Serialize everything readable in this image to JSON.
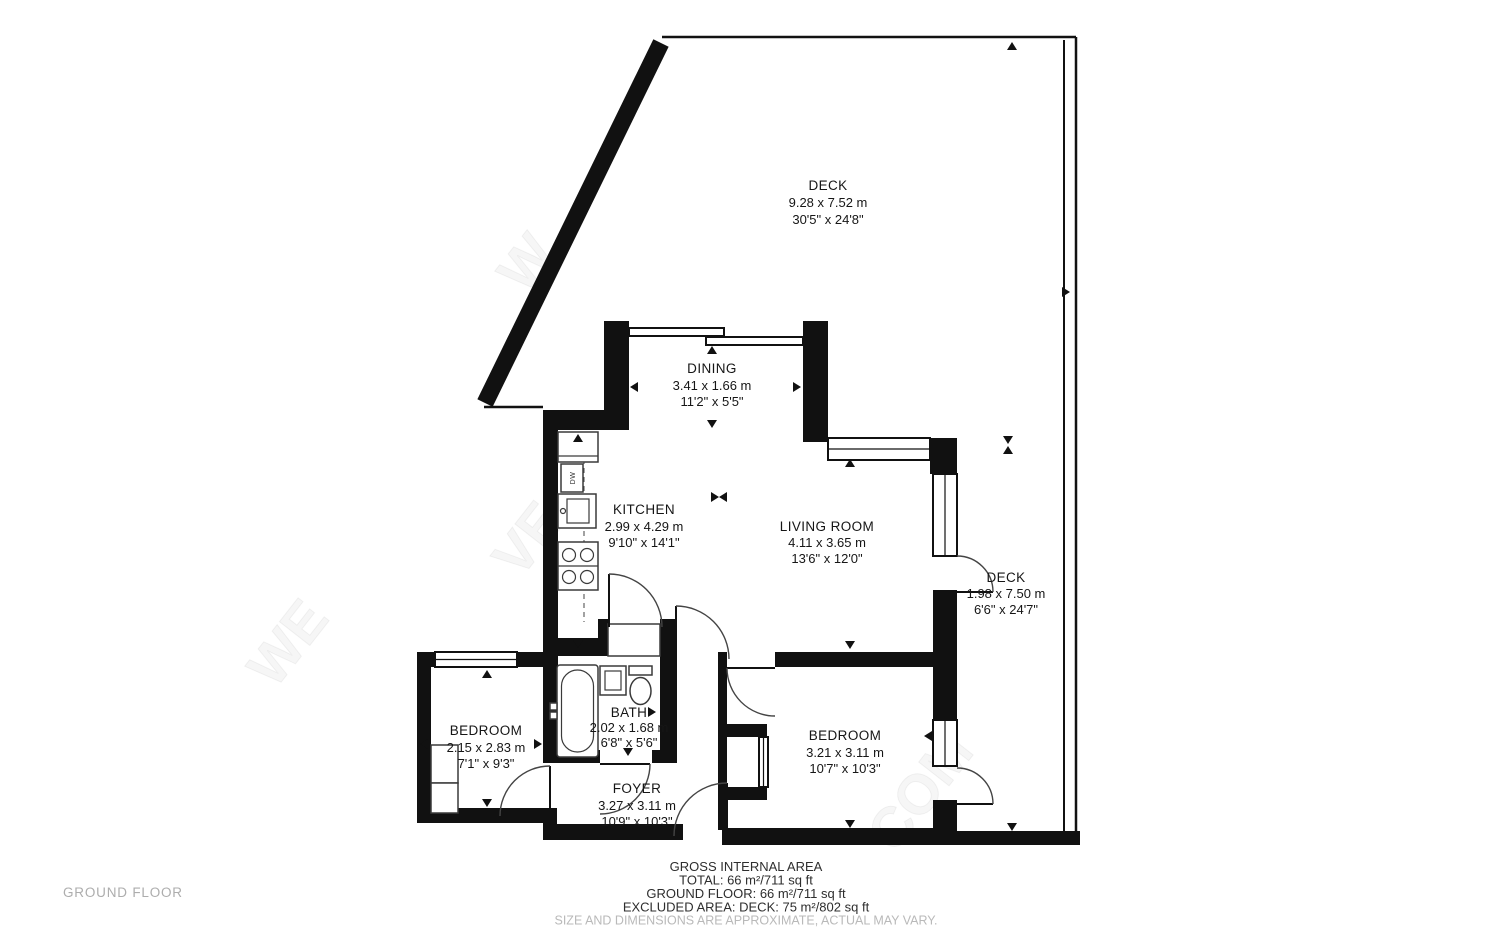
{
  "floor_label": "GROUND FLOOR",
  "rooms": [
    {
      "id": "deck-main",
      "name": "DECK",
      "metric": "9.28 x 7.52 m",
      "imperial": "30'5\" x 24'8\""
    },
    {
      "id": "dining",
      "name": "DINING",
      "metric": "3.41 x 1.66 m",
      "imperial": "11'2\" x 5'5\""
    },
    {
      "id": "kitchen",
      "name": "KITCHEN",
      "metric": "2.99 x 4.29 m",
      "imperial": "9'10\" x 14'1\""
    },
    {
      "id": "living-room",
      "name": "LIVING ROOM",
      "metric": "4.11 x 3.65 m",
      "imperial": "13'6\" x 12'0\""
    },
    {
      "id": "deck-side",
      "name": "DECK",
      "metric": "1.98 x 7.50 m",
      "imperial": "6'6\" x 24'7\""
    },
    {
      "id": "bedroom-left",
      "name": "BEDROOM",
      "metric": "2.15 x 2.83 m",
      "imperial": "7'1\" x 9'3\""
    },
    {
      "id": "bath",
      "name": "BATH",
      "metric": "2.02 x 1.68 m",
      "imperial": "6'8\" x 5'6\""
    },
    {
      "id": "bedroom-right",
      "name": "BEDROOM",
      "metric": "3.21 x 3.11 m",
      "imperial": "10'7\" x 10'3\""
    },
    {
      "id": "foyer",
      "name": "FOYER",
      "metric": "3.27 x 3.11 m",
      "imperial": "10'9\" x 10'3\""
    }
  ],
  "summary": {
    "title": "GROSS INTERNAL AREA",
    "total": "TOTAL: 66 m²/711 sq ft",
    "ground_floor": "GROUND FLOOR: 66 m²/711 sq ft",
    "excluded": "EXCLUDED AREA: DECK: 75 m²/802 sq ft",
    "disclaimer": "SIZE AND DIMENSIONS ARE APPROXIMATE, ACTUAL MAY VARY."
  },
  "fixtures": {
    "dishwasher_label": "DW"
  },
  "watermark": [
    "WE",
    "VE",
    "COM",
    "W"
  ],
  "colors": {
    "wall": "#111111",
    "text": "#161616",
    "muted": "#adadad",
    "disclaimer": "#b9b9b9",
    "background": "#ffffff"
  }
}
